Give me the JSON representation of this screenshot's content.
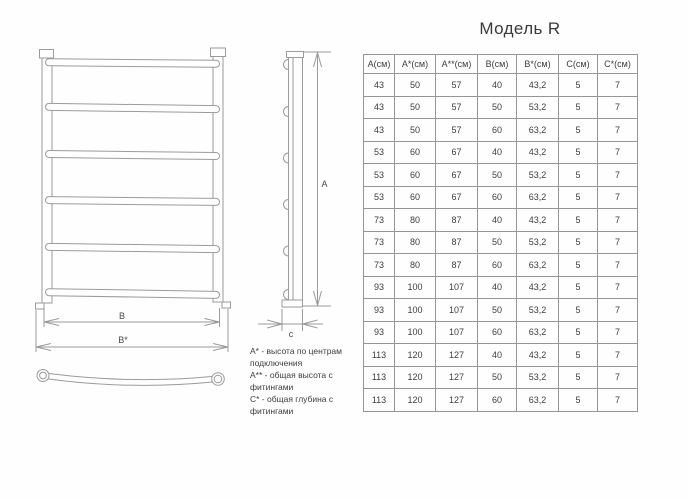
{
  "title": "Модель R",
  "table": {
    "headers": [
      "А(см)",
      "А*(см)",
      "А**(см)",
      "В(см)",
      "В*(см)",
      "С(см)",
      "С*(см)"
    ],
    "rows": [
      [
        "43",
        "50",
        "57",
        "40",
        "43,2",
        "5",
        "7"
      ],
      [
        "43",
        "50",
        "57",
        "50",
        "53,2",
        "5",
        "7"
      ],
      [
        "43",
        "50",
        "57",
        "60",
        "63,2",
        "5",
        "7"
      ],
      [
        "53",
        "60",
        "67",
        "40",
        "43,2",
        "5",
        "7"
      ],
      [
        "53",
        "60",
        "67",
        "50",
        "53,2",
        "5",
        "7"
      ],
      [
        "53",
        "60",
        "67",
        "60",
        "63,2",
        "5",
        "7"
      ],
      [
        "73",
        "80",
        "87",
        "40",
        "43,2",
        "5",
        "7"
      ],
      [
        "73",
        "80",
        "87",
        "50",
        "53,2",
        "5",
        "7"
      ],
      [
        "73",
        "80",
        "87",
        "60",
        "63,2",
        "5",
        "7"
      ],
      [
        "93",
        "100",
        "107",
        "40",
        "43,2",
        "5",
        "7"
      ],
      [
        "93",
        "100",
        "107",
        "50",
        "53,2",
        "5",
        "7"
      ],
      [
        "93",
        "100",
        "107",
        "60",
        "63,2",
        "5",
        "7"
      ],
      [
        "113",
        "120",
        "127",
        "40",
        "43,2",
        "5",
        "7"
      ],
      [
        "113",
        "120",
        "127",
        "50",
        "53,2",
        "5",
        "7"
      ],
      [
        "113",
        "120",
        "127",
        "60",
        "63,2",
        "5",
        "7"
      ]
    ]
  },
  "legend": {
    "items": [
      {
        "text": "А* - высота по центрам подключения"
      },
      {
        "text": "А** - общая высота с фитингами"
      },
      {
        "text": "С* - общая глубина с фитингами"
      }
    ]
  },
  "drawing": {
    "labels": {
      "width": "В",
      "width_total": "В*",
      "height": "А",
      "depth": "с"
    }
  },
  "colors": {
    "drawing_line": "#9b9b9b",
    "table_border": "#959595",
    "text": "#3d3d3d"
  }
}
